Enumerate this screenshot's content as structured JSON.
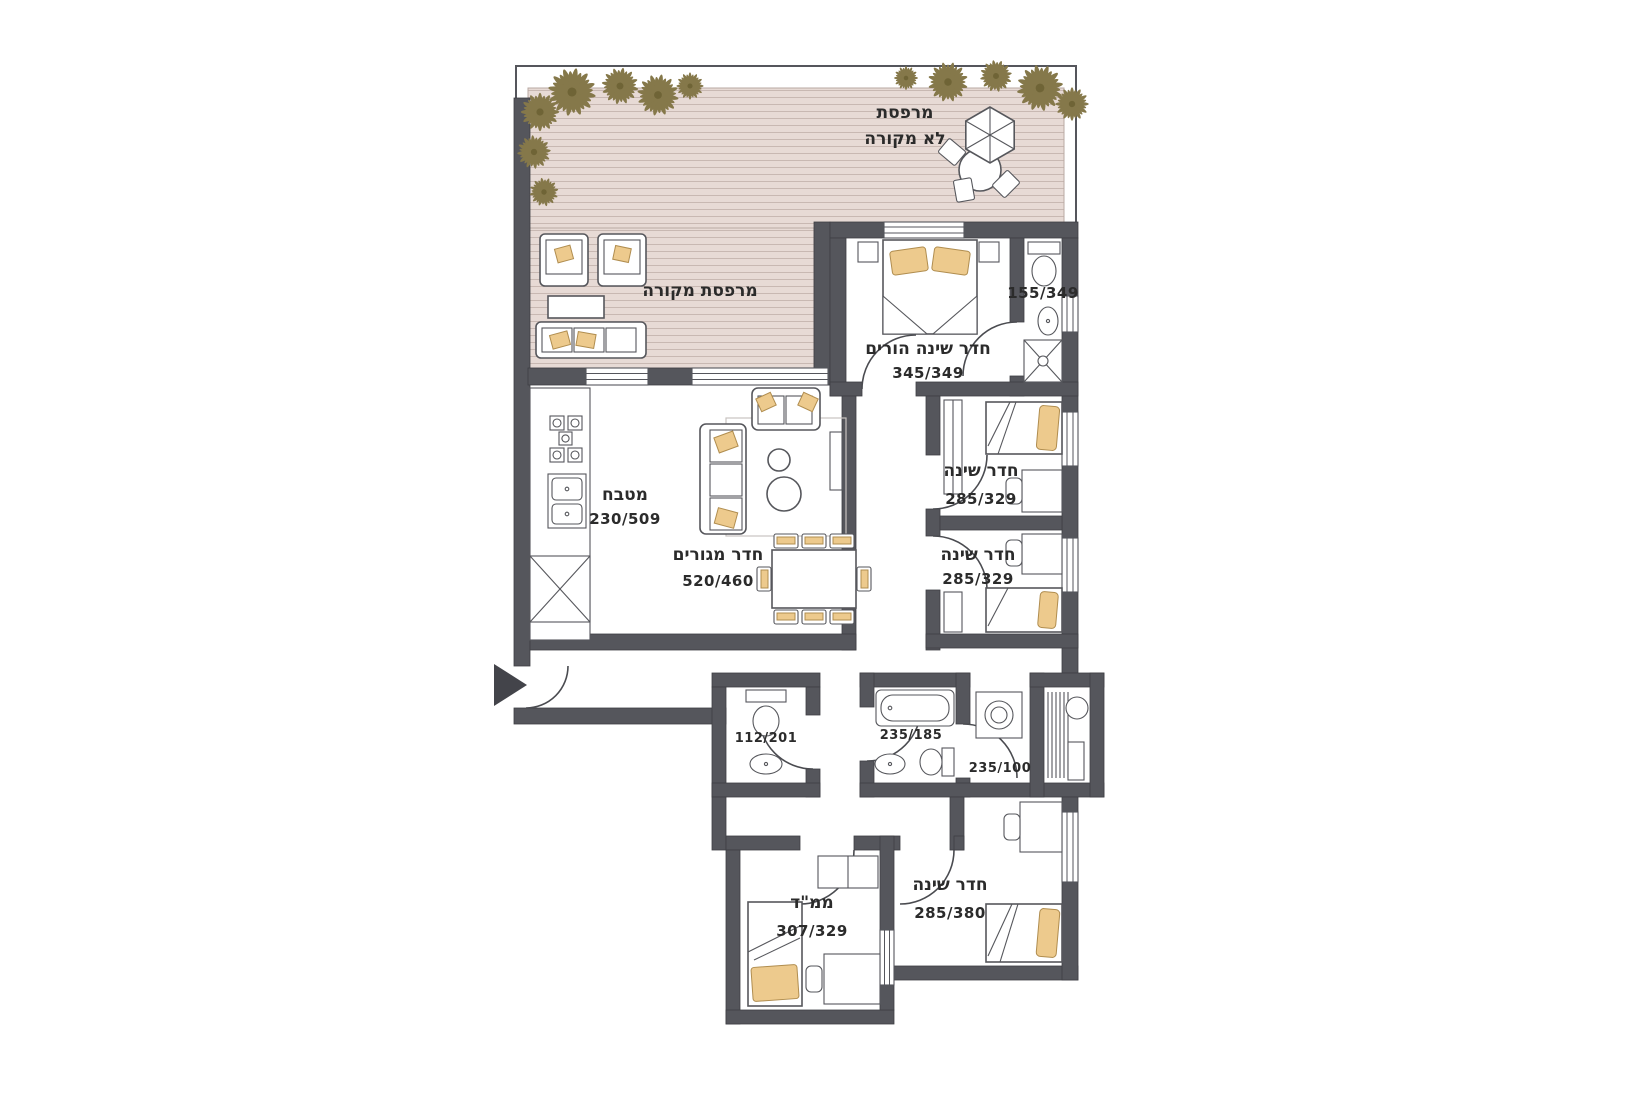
{
  "plan": {
    "type": "apartment-floor-plan",
    "language": "hebrew",
    "rooms": {
      "open_terrace": {
        "label_line1": "מרפסת",
        "label_line2": "לא מקורה"
      },
      "covered_terrace": {
        "label": "מרפסת מקורה"
      },
      "master_bedroom": {
        "label": "חדר שינה הורים",
        "dims": "345/349"
      },
      "master_bath": {
        "dims": "155/349"
      },
      "bedroom_1": {
        "label": "חדר שינה",
        "dims": "285/329"
      },
      "bedroom_2": {
        "label": "חדר שינה",
        "dims": "285/329"
      },
      "kitchen": {
        "label": "מטבח",
        "dims": "230/509"
      },
      "living_room": {
        "label": "חדר מגורים",
        "dims": "520/460"
      },
      "wc": {
        "dims": "112/201"
      },
      "bathroom": {
        "dims": "235/185"
      },
      "laundry": {
        "dims": "235/100"
      },
      "bedroom_3": {
        "label": "חדר שינה",
        "dims": "285/380"
      },
      "safe_room": {
        "label": "ממ\"ד",
        "dims": "307/329"
      }
    },
    "colors": {
      "wall": "#55565c",
      "deck": "#e7dad5",
      "deck_stripe": "#c8b8b2",
      "plant": "#85784a",
      "cushion": "#edca8d",
      "line": "#56575c",
      "background": "#ffffff"
    }
  }
}
